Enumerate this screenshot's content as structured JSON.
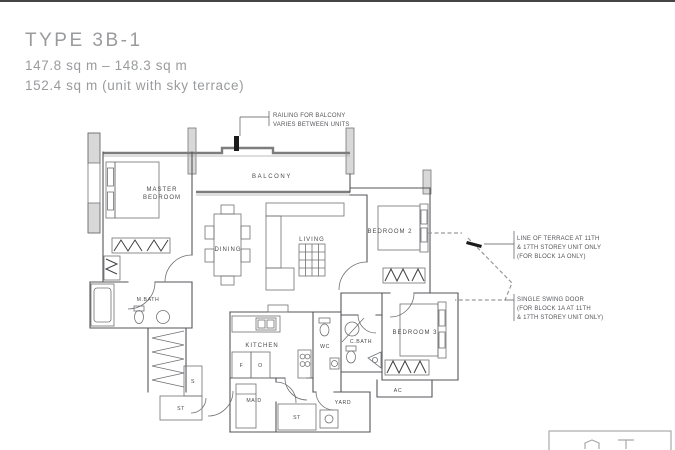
{
  "title": {
    "type_label": "TYPE 3B-1",
    "area_range": "147.8 sq m – 148.3 sq m",
    "area_sky_terrace": "152.4 sq m (unit with sky terrace)"
  },
  "rooms": {
    "master_bedroom_line1": "MASTER",
    "master_bedroom_line2": "BEDROOM",
    "balcony": "BALCONY",
    "dining": "DINING",
    "living": "LIVING",
    "bedroom2": "BEDROOM 2",
    "bedroom3": "BEDROOM 3",
    "master_bath": "M.BATH",
    "kitchen": "KITCHEN",
    "wc": "WC",
    "common_bath": "C.BATH",
    "maid": "MAID",
    "yard": "YARD",
    "store1": "ST",
    "store2": "ST",
    "shoe_cabinet": "S",
    "ac_ledge": "AC",
    "fridge": "F",
    "oven": "O"
  },
  "annotations": {
    "railing": [
      "RAILING FOR BALCONY",
      "VARIES BETWEEN UNITS"
    ],
    "terrace": [
      "LINE OF TERRACE AT 11TH",
      "& 17TH STOREY UNIT ONLY",
      "(FOR BLOCK 1A ONLY)"
    ],
    "swing_door": [
      "SINGLE SWING DOOR",
      "(FOR BLOCK 1A AT 11TH",
      "& 17TH STOREY UNIT ONLY)"
    ]
  },
  "colors": {
    "wall": "#55565a",
    "furniture": "#707174",
    "text": "#4a4a4c",
    "title_gray": "#9a9b9d",
    "accent_black": "#1b1b1b"
  }
}
